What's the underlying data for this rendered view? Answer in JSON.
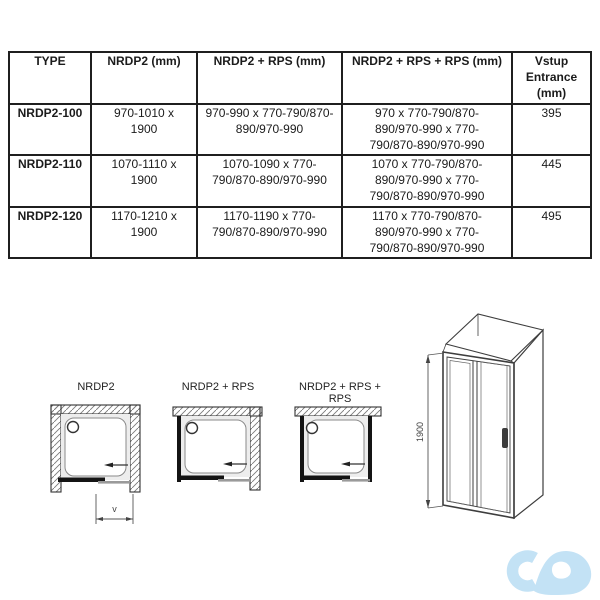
{
  "table": {
    "headers": [
      "TYPE",
      "NRDP2 (mm)",
      "NRDP2 + RPS (mm)",
      "NRDP2 + RPS + RPS (mm)",
      "Vstup\nEntrance\n(mm)"
    ],
    "rows": [
      {
        "cells": [
          "NRDP2-100",
          "970-1010 x\n1900",
          "970-990 x 770-790/870-\n890/970-990",
          "970 x 770-790/870-\n890/970-990 x 770-\n790/870-890/970-990",
          "395"
        ]
      },
      {
        "cells": [
          "NRDP2-110",
          "1070-1110 x\n1900",
          "1070-1090 x 770-\n790/870-890/970-990",
          "1070 x 770-790/870-\n890/970-990 x 770-\n790/870-890/970-990",
          "445"
        ]
      },
      {
        "cells": [
          "NRDP2-120",
          "1170-1210 x\n1900",
          "1170-1190 x 770-\n790/870-890/970-990",
          "1170 x 770-790/870-\n890/970-990 x 770-\n790/870-890/970-990",
          "495"
        ]
      }
    ]
  },
  "diagrams": {
    "plan1": {
      "label": "NRDP2"
    },
    "plan2": {
      "label": "NRDP2 + RPS"
    },
    "plan3": {
      "label": "NRDP2 + RPS + RPS"
    },
    "v_label": "v",
    "height_label": "1900"
  },
  "icons": {
    "logo": "cd-infinity-watermark",
    "slide_arrow": "left-arrow",
    "drain": "drain-circle"
  },
  "colors": {
    "line_black": "#1f1f1f",
    "panel_gray": "#9a9a9a",
    "tray_gray": "#ededed",
    "logo_blue": "#c3e2f5"
  }
}
